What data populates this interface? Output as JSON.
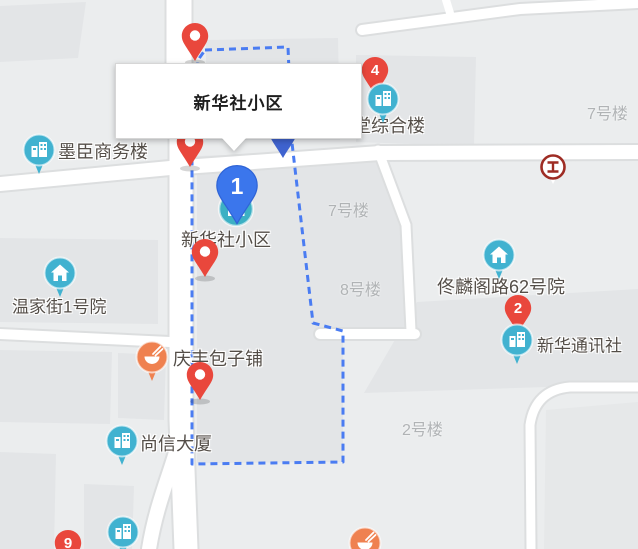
{
  "tooltip": {
    "title": "新华社小区"
  },
  "markers": {
    "main": {
      "label": "1"
    },
    "m2": {
      "label": "2"
    },
    "m4": {
      "label": "4"
    },
    "m9": {
      "label": "9"
    }
  },
  "poi_labels": [
    {
      "text": "墨臣商务楼"
    },
    {
      "text": "温家街1号院"
    },
    {
      "text": "尚信大厦"
    },
    {
      "text": "庆丰包子铺"
    },
    {
      "text": "新华社小区"
    },
    {
      "text": "堂综合楼"
    },
    {
      "text": "佟麟阁路62号院"
    },
    {
      "text": "新华通讯社"
    }
  ],
  "building_labels": [
    {
      "text": "7号楼"
    },
    {
      "text": "7号楼"
    },
    {
      "text": "8号楼"
    },
    {
      "text": "2号楼"
    }
  ],
  "colors": {
    "map_background": "#ebedee",
    "building_fill": "#e3e5e7",
    "road": "#ffffff",
    "boundary_blue": "#4a7cf2",
    "pin_red": "#e9473c",
    "pin_blue": "#3b76ec",
    "pin_blue_dark": "#3f63cf",
    "poi_teal": "#41b2d0",
    "poi_orange": "#ef8150",
    "bank_red": "#9e2c24",
    "label_dark": "#544e48",
    "label_gray": "#b0b3b5"
  }
}
